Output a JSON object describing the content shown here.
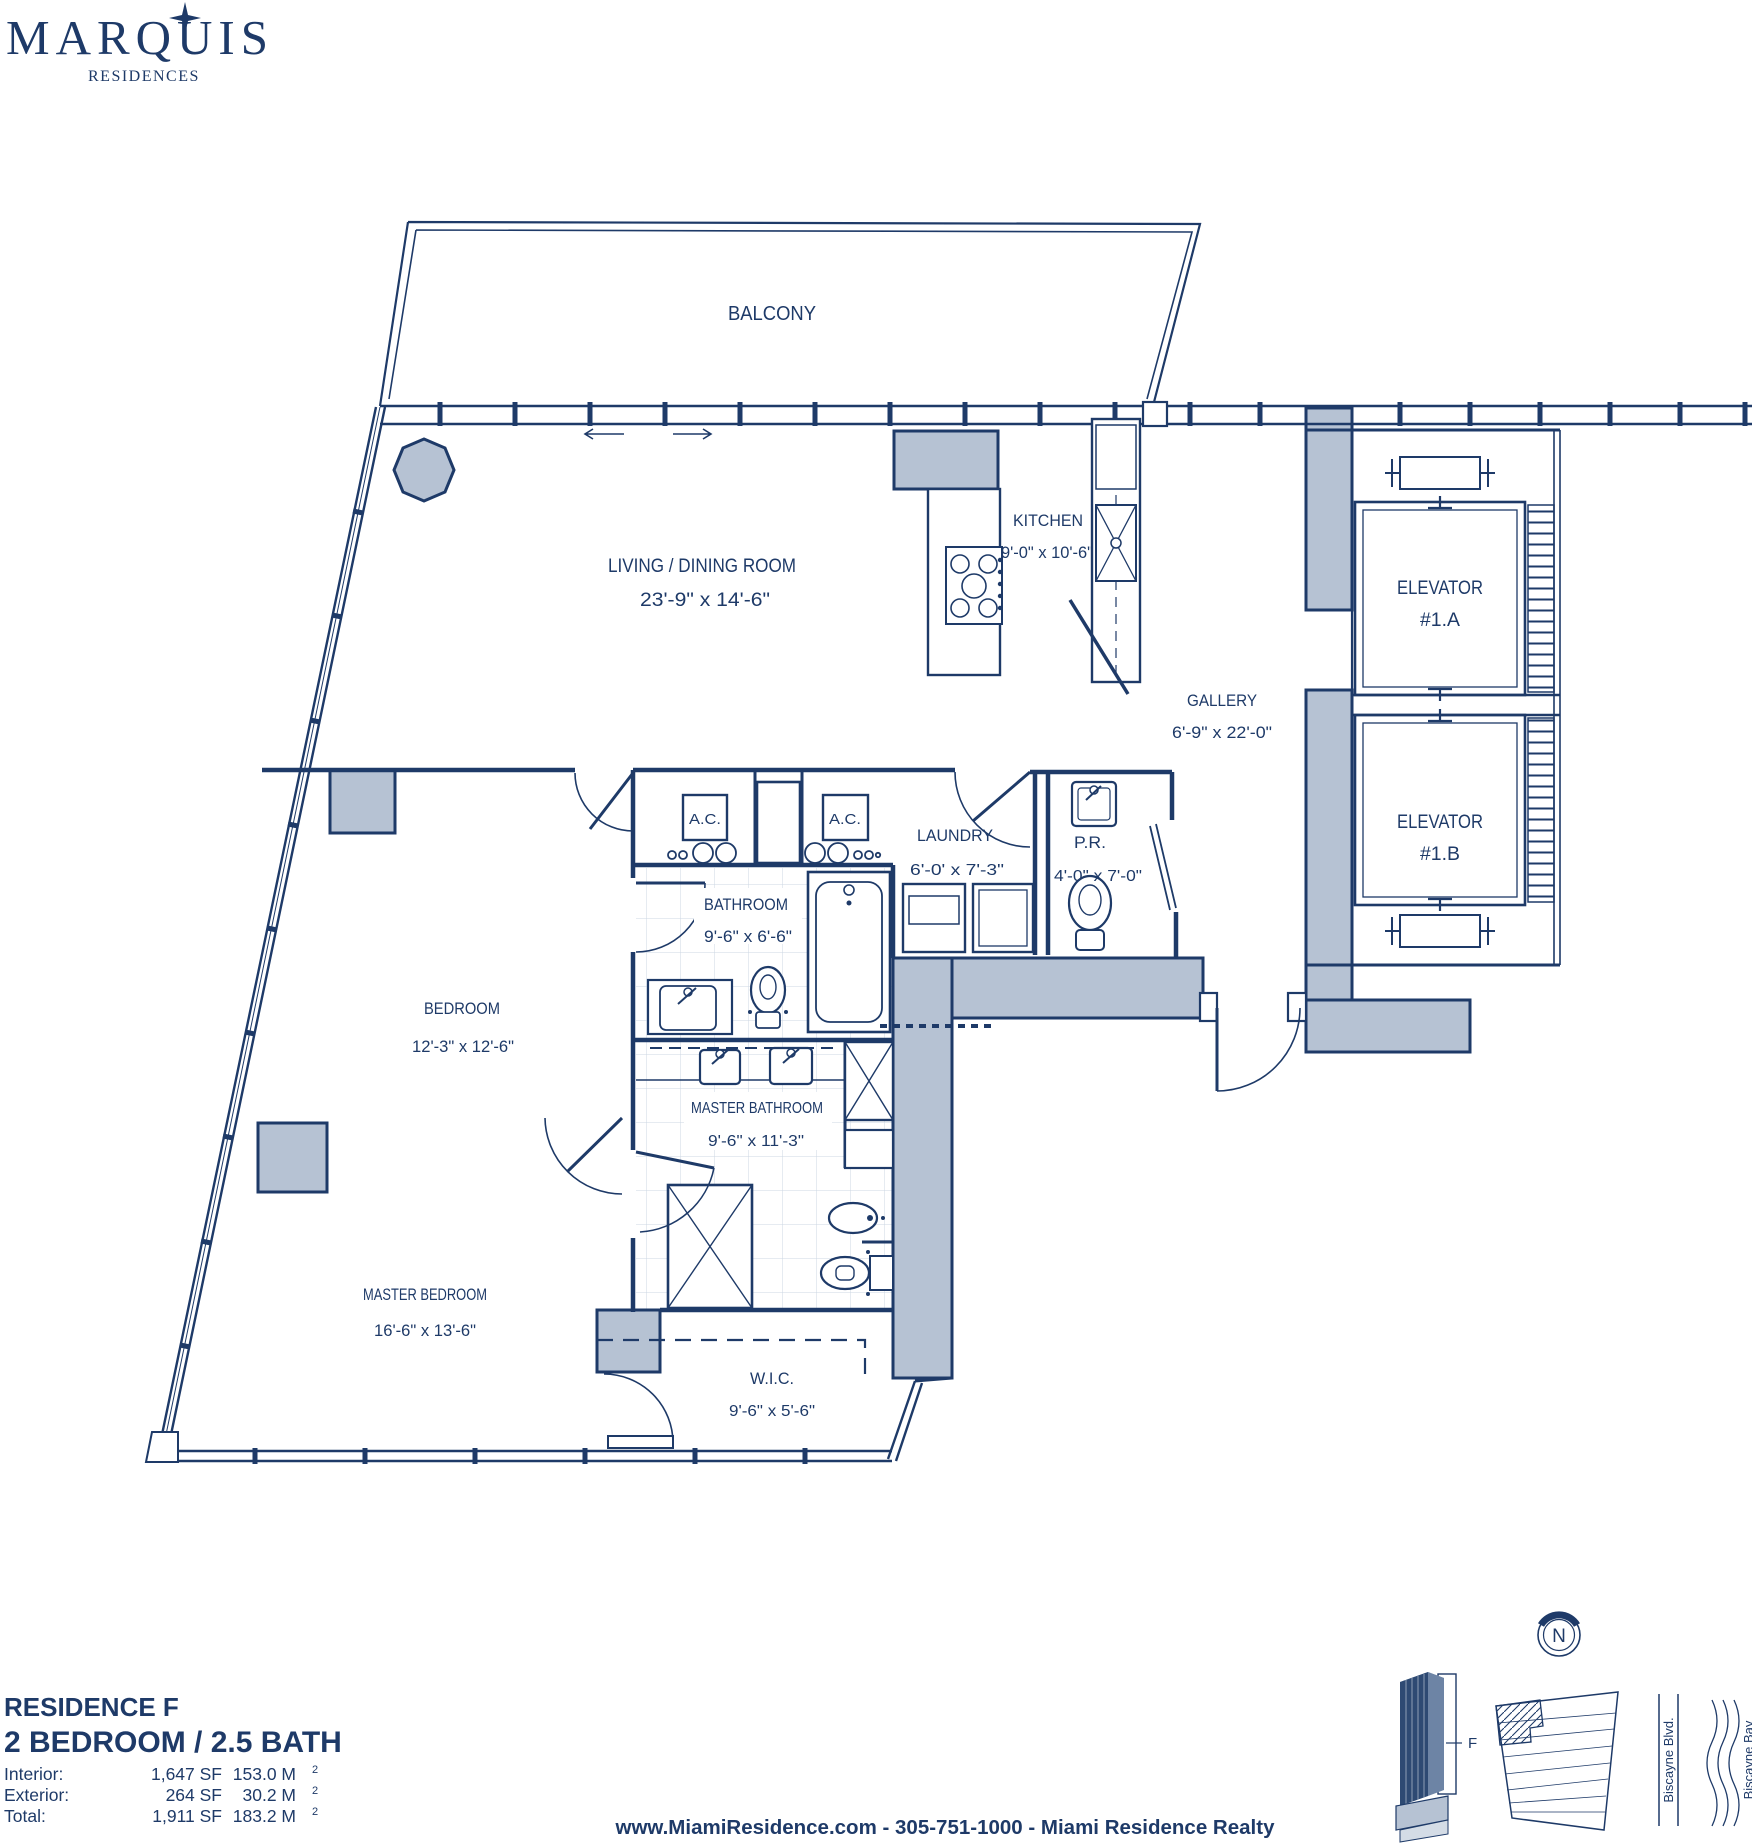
{
  "logo": {
    "title": "MARQUIS",
    "subtitle": "RESIDENCES"
  },
  "plan": {
    "balcony": {
      "name": "BALCONY"
    },
    "living": {
      "name": "LIVING / DINING ROOM",
      "dims": "23'-9\" x 14'-6\""
    },
    "kitchen": {
      "name": "KITCHEN",
      "dims": "9'-0\" x 10'-6\""
    },
    "gallery": {
      "name": "GALLERY",
      "dims": "6'-9\" x 22'-0\""
    },
    "elevator_a": {
      "name": "ELEVATOR",
      "num": "#1.A"
    },
    "elevator_b": {
      "name": "ELEVATOR",
      "num": "#1.B"
    },
    "ac": {
      "name": "A.C."
    },
    "laundry": {
      "name": "LAUNDRY",
      "dims": "6'-0' x 7'-3\""
    },
    "pr": {
      "name": "P.R.",
      "dims": "4'-0\" x 7'-0\""
    },
    "bathroom": {
      "name": "BATHROOM",
      "dims": "9'-6\" x 6'-6\""
    },
    "bedroom": {
      "name": "BEDROOM",
      "dims": "12'-3\" x 12'-6\""
    },
    "master_bathroom": {
      "name": "MASTER BATHROOM",
      "dims": "9'-6\" x 11'-3\""
    },
    "master_bedroom": {
      "name": "MASTER BEDROOM",
      "dims": "16'-6\" x 13'-6\""
    },
    "wic": {
      "name": "W.I.C.",
      "dims": "9'-6\" x 5'-6\""
    }
  },
  "info": {
    "residence": "RESIDENCE F",
    "layout": "2 BEDROOM / 2.5 BATH",
    "rows": [
      {
        "label": "Interior:",
        "sf": "1,647 SF",
        "m": "153.0 M",
        "sup": "2"
      },
      {
        "label": "Exterior:",
        "sf": "264 SF",
        "m": "30.2 M",
        "sup": "2"
      },
      {
        "label": "Total:",
        "sf": "1,911 SF",
        "m": "183.2 M",
        "sup": "2"
      }
    ]
  },
  "footer": {
    "line": "www.MiamiResidence.com  -  305-751-1000  -  Miami Residence Realty"
  },
  "locator": {
    "compass": "N",
    "unit": "F",
    "street": "Biscayne Blvd.",
    "bay": "Biscayne Bay"
  },
  "colors": {
    "navy": "#1e3a68",
    "gray_fill": "#b6c2d3"
  }
}
